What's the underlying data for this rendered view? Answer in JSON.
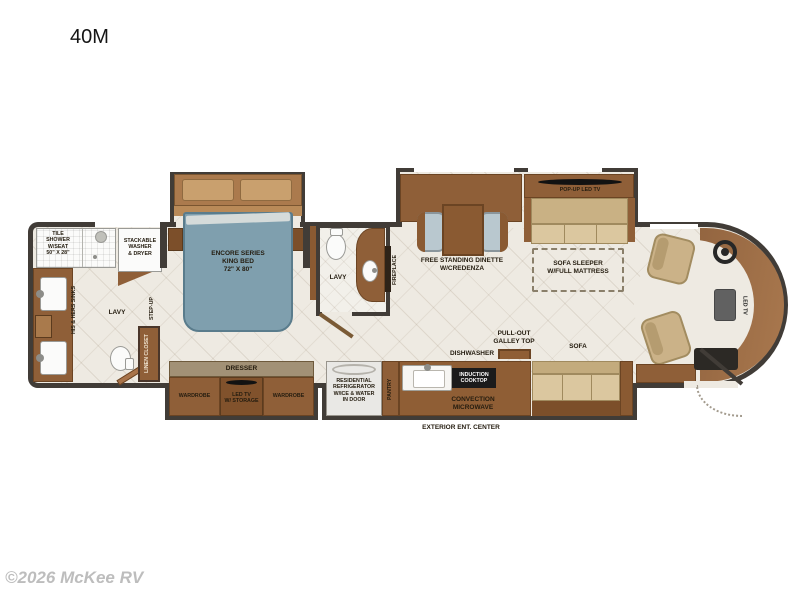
{
  "title": "40M",
  "watermark": "©2026 McKee RV",
  "colors": {
    "wall": "#413c37",
    "floor": "#eeeae2",
    "cabinet_brown": "#8f5f38",
    "bed_blue": "#7f9fae",
    "sofa_tan": "#dbc79f",
    "fixture_white": "#fbfbfa",
    "cooktop_black": "#1b1b1b",
    "watermark_gray": "#bdbdbd"
  },
  "labels": {
    "tile_shower": "TILE\nSHOWER\nW/SEAT\n50\" X 28\"",
    "washer_dryer": "STACKABLE\nWASHER\n& DRYER",
    "his_hers_sinks": "HIS & HERS SINKS",
    "lavy_rear": "LAVY",
    "step_up": "STEP-UP",
    "linen_closet": "LINEN CLOSET",
    "king_bed": "ENCORE SERIES\nKING BED\n72\"  X 80\"",
    "dresser": "DRESSER",
    "wardrobe_left": "WARDROBE",
    "led_tv_storage": "LED TV\nW/ STORAGE",
    "wardrobe_right": "WARDROBE",
    "lavy_mid": "LAVY",
    "fireplace": "FIREPLACE",
    "dinette": "FREE STANDING DINETTE\nW/CREDENZA",
    "refrigerator": "RESIDENTIAL\nREFRIGERATOR\nW/ICE & WATER\nIN DOOR",
    "pantry": "PANTRY",
    "dishwasher": "DISHWASHER",
    "induction_cooktop": "INDUCTION\nCOOKTOP",
    "convection_microwave": "CONVECTION\nMICROWAVE",
    "galley_top": "PULL-OUT\nGALLEY TOP",
    "sofa": "SOFA",
    "pop_up_tv": "POP-UP LED TV",
    "sofa_sleeper": "SOFA SLEEPER\nW/FULL MATTRESS",
    "front_tv": "LED TV",
    "exterior_ent": "EXTERIOR ENT. CENTER"
  }
}
